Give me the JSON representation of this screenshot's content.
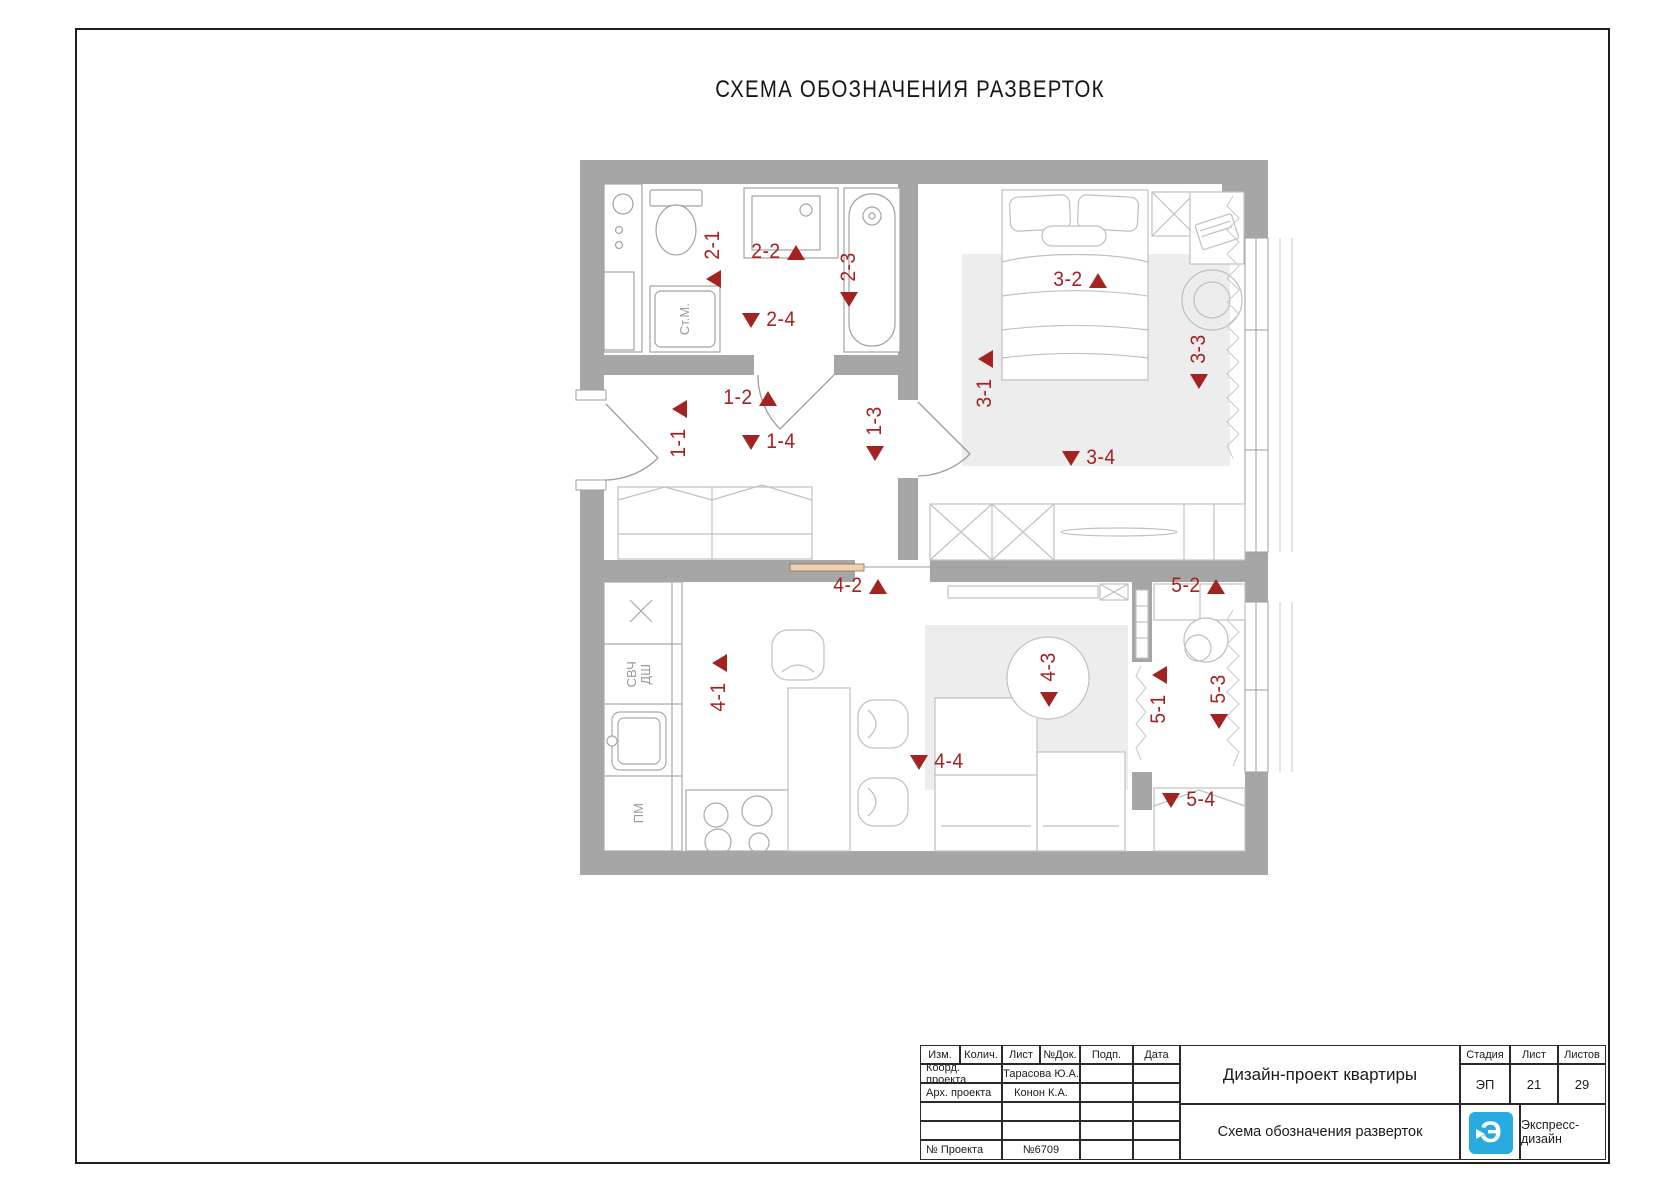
{
  "sheet": {
    "title": "СХЕМА ОБОЗНАЧЕНИЯ РАЗВЕРТОК"
  },
  "colors": {
    "marker_red": "#a32323",
    "wall_gray": "#a6a6a6",
    "logo_blue": "#29abe2",
    "rug_gray": "#ededed"
  },
  "plan": {
    "room_labels": {
      "washing_machine": "Ст.М.",
      "microwave": "СВЧ",
      "oven": "ДШ",
      "dishwasher": "ПМ"
    },
    "markers": [
      {
        "label": "1-1",
        "type": "v-up-top",
        "x": 666,
        "y": 400
      },
      {
        "label": "1-2",
        "type": "h-up",
        "x": 722,
        "y": 386
      },
      {
        "label": "1-3",
        "type": "v-down",
        "x": 862,
        "y": 398
      },
      {
        "label": "1-4",
        "type": "h-down",
        "x": 742,
        "y": 430
      },
      {
        "label": "2-1",
        "type": "v-up-bottom",
        "x": 700,
        "y": 222
      },
      {
        "label": "2-2",
        "type": "h-up",
        "x": 750,
        "y": 240
      },
      {
        "label": "2-3",
        "type": "v-down",
        "x": 836,
        "y": 244
      },
      {
        "label": "2-4",
        "type": "h-down",
        "x": 742,
        "y": 308
      },
      {
        "label": "3-1",
        "type": "v-up-top",
        "x": 972,
        "y": 350
      },
      {
        "label": "3-2",
        "type": "h-up",
        "x": 1052,
        "y": 268
      },
      {
        "label": "3-3",
        "type": "v-down",
        "x": 1186,
        "y": 326
      },
      {
        "label": "3-4",
        "type": "h-down",
        "x": 1062,
        "y": 446
      },
      {
        "label": "4-1",
        "type": "v-up-top",
        "x": 706,
        "y": 654
      },
      {
        "label": "4-2",
        "type": "h-up",
        "x": 832,
        "y": 574
      },
      {
        "label": "4-3",
        "type": "v-down",
        "x": 1036,
        "y": 644
      },
      {
        "label": "4-4",
        "type": "h-down",
        "x": 910,
        "y": 750
      },
      {
        "label": "5-1",
        "type": "v-up-top",
        "x": 1146,
        "y": 666
      },
      {
        "label": "5-2",
        "type": "h-up",
        "x": 1170,
        "y": 574
      },
      {
        "label": "5-3",
        "type": "v-down",
        "x": 1206,
        "y": 666
      },
      {
        "label": "5-4",
        "type": "h-down",
        "x": 1162,
        "y": 788
      }
    ]
  },
  "title_block": {
    "stamp": {
      "headers": [
        "Изм.",
        "Колич.",
        "Лист",
        "№Док.",
        "Подп.",
        "Дата"
      ],
      "coord_label": "Коорд. проекта",
      "coord_value": "Тарасова Ю.А.",
      "arch_label": "Арх. проекта",
      "arch_value": "Конон К.А.",
      "project_label": "№ Проекта",
      "project_value": "№6709"
    },
    "project_title": "Дизайн-проект квартиры",
    "sheet_title": "Схема обозначения разверток",
    "stage_label": "Стадия",
    "stage_value": "ЭП",
    "sheet_label": "Лист",
    "sheet_value": "21",
    "total_label": "Листов",
    "total_value": "29",
    "brand": "Экспресс-дизайн",
    "logo_letter": "Э"
  }
}
